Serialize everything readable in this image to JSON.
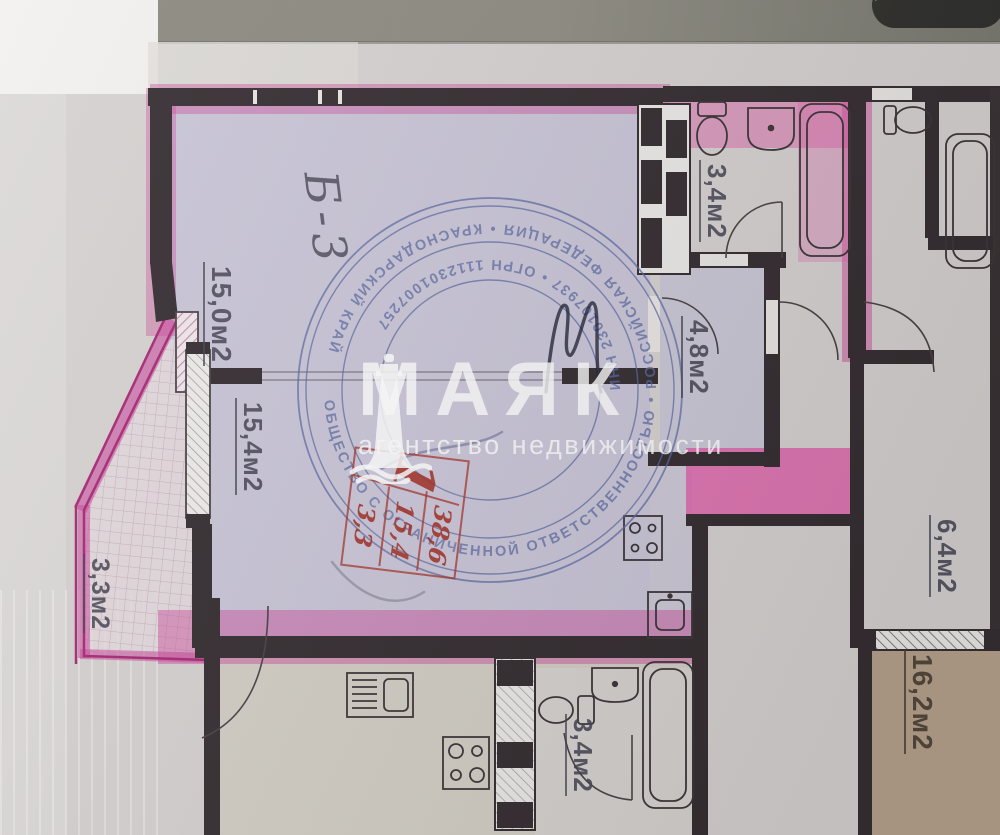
{
  "plan": {
    "unit_mark": "Б-3",
    "rooms": {
      "living": "15,0м2",
      "kitchen": "15,4м2",
      "balcony": "3,3м2",
      "hall": "4,8м2",
      "bathroom_top": "3,4м2",
      "corridor": "6,4м2",
      "room_right": "16,2м2",
      "bathroom_bottom": "3,4м2"
    }
  },
  "agency_stamp": {
    "ring_outer": "ОБЩЕСТВО С ОГРАНИЧЕННОЙ ОТВЕТСТВЕННОСТЬЮ  •  РОССИЙСКАЯ ФЕДЕРАЦИЯ  •  КРАСНОДАРСКИЙ КРАЙ",
    "ring_inner": "ИНН 230107937  •  ОГРН 1112301007257"
  },
  "area_stamp": {
    "number": "1",
    "total": "38,6",
    "living": "15,4",
    "extra": "3,3"
  },
  "watermark": {
    "name": "МАЯК",
    "subtitle": "агентство недвижимости"
  },
  "colors": {
    "highlight_pink": "#cf4f9e",
    "apartment_fill": "#c6c3da",
    "stamp_blue": "#5b6aa3",
    "stamp_red": "#a63b31",
    "room_tan": "#b29c85"
  }
}
